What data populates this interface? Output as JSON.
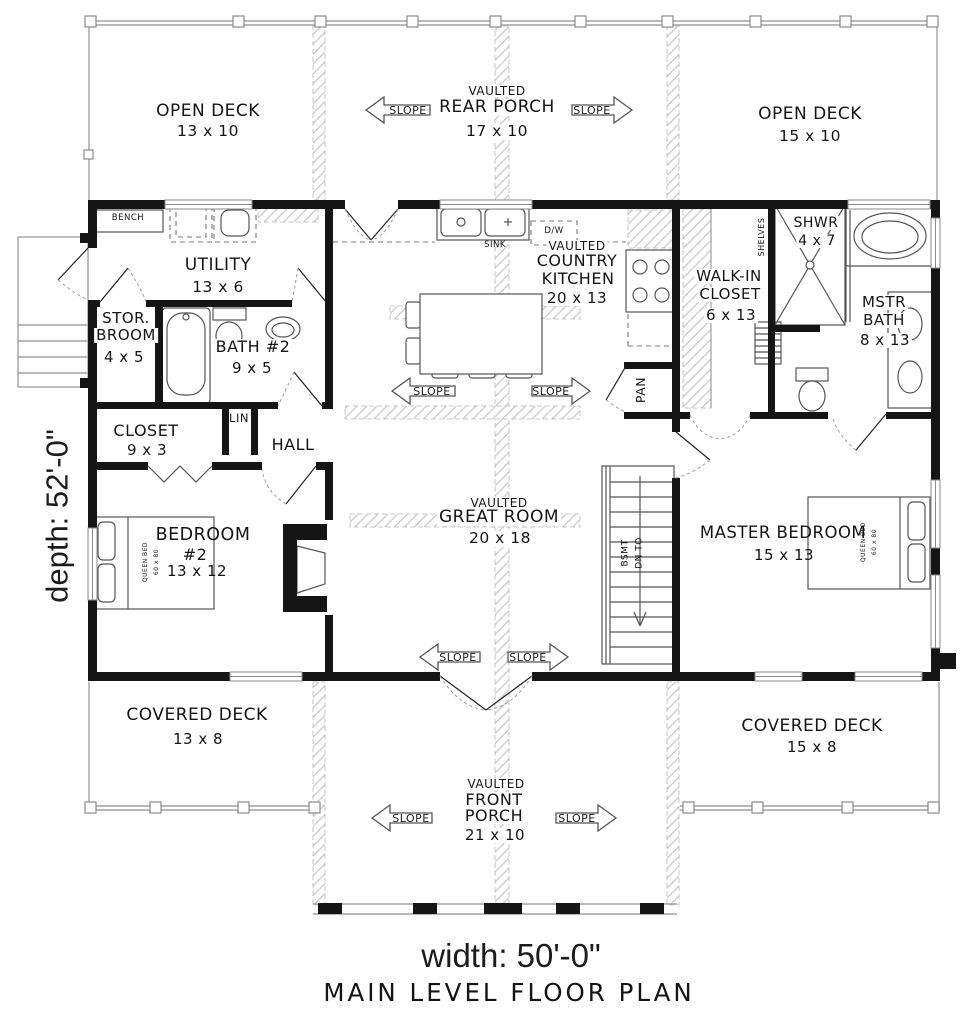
{
  "slope_label": "SLOPE",
  "rooms": {
    "open_deck_left": {
      "name": "OPEN DECK",
      "size": "13 x 10"
    },
    "rear_porch": {
      "prefix": "VAULTED",
      "name": "REAR PORCH",
      "size": "17 x 10"
    },
    "open_deck_right": {
      "name": "OPEN DECK",
      "size": "15 x 10"
    },
    "utility": {
      "name": "UTILITY",
      "size": "13 x 6"
    },
    "country_kitchen": {
      "prefix": "VAULTED",
      "line1": "COUNTRY",
      "line2": "KITCHEN",
      "size": "20 x 13"
    },
    "stor_broom": {
      "line1": "STOR.",
      "line2": "BROOM",
      "size": "4 x 5"
    },
    "bath2": {
      "name": "BATH #2",
      "size": "9 x 5"
    },
    "linen": {
      "name": "LIN"
    },
    "closet": {
      "name": "CLOSET",
      "size": "9 x 3"
    },
    "hall": {
      "name": "HALL"
    },
    "shower": {
      "name": "SHWR",
      "size": "4 x 7"
    },
    "walk_in_closet": {
      "line1": "WALK-IN",
      "line2": "CLOSET",
      "size": "6 x 13"
    },
    "master_bath": {
      "line1": "MSTR",
      "line2": "BATH",
      "size": "8 x 13"
    },
    "pantry": {
      "name": "PAN"
    },
    "great_room": {
      "prefix": "VAULTED",
      "name": "GREAT ROOM",
      "size": "20 x 18"
    },
    "bedroom2": {
      "line1": "BEDROOM",
      "line2": "#2",
      "size": "13 x 12"
    },
    "master_bedroom": {
      "name": "MASTER BEDROOM",
      "size": "15 x 13"
    },
    "covered_deck_left": {
      "name": "COVERED DECK",
      "size": "13 x 8"
    },
    "covered_deck_right": {
      "name": "COVERED DECK",
      "size": "15 x 8"
    },
    "front_porch": {
      "prefix": "VAULTED",
      "line1": "FRONT",
      "line2": "PORCH",
      "size": "21 x 10"
    }
  },
  "annotations": {
    "bench": "BENCH",
    "sink": "SINK",
    "dishwasher": "D/W",
    "shelves": "SHELVES",
    "stairs": {
      "line1": "BSMT",
      "line2": "DN TO"
    },
    "bed_note": {
      "line1": "QUEEN BED",
      "line2": "60 x 80"
    }
  },
  "footer": {
    "width_label": "width: 50'-0\"",
    "depth_label": "depth: 52'-0\"",
    "title": "MAIN LEVEL FLOOR PLAN"
  }
}
